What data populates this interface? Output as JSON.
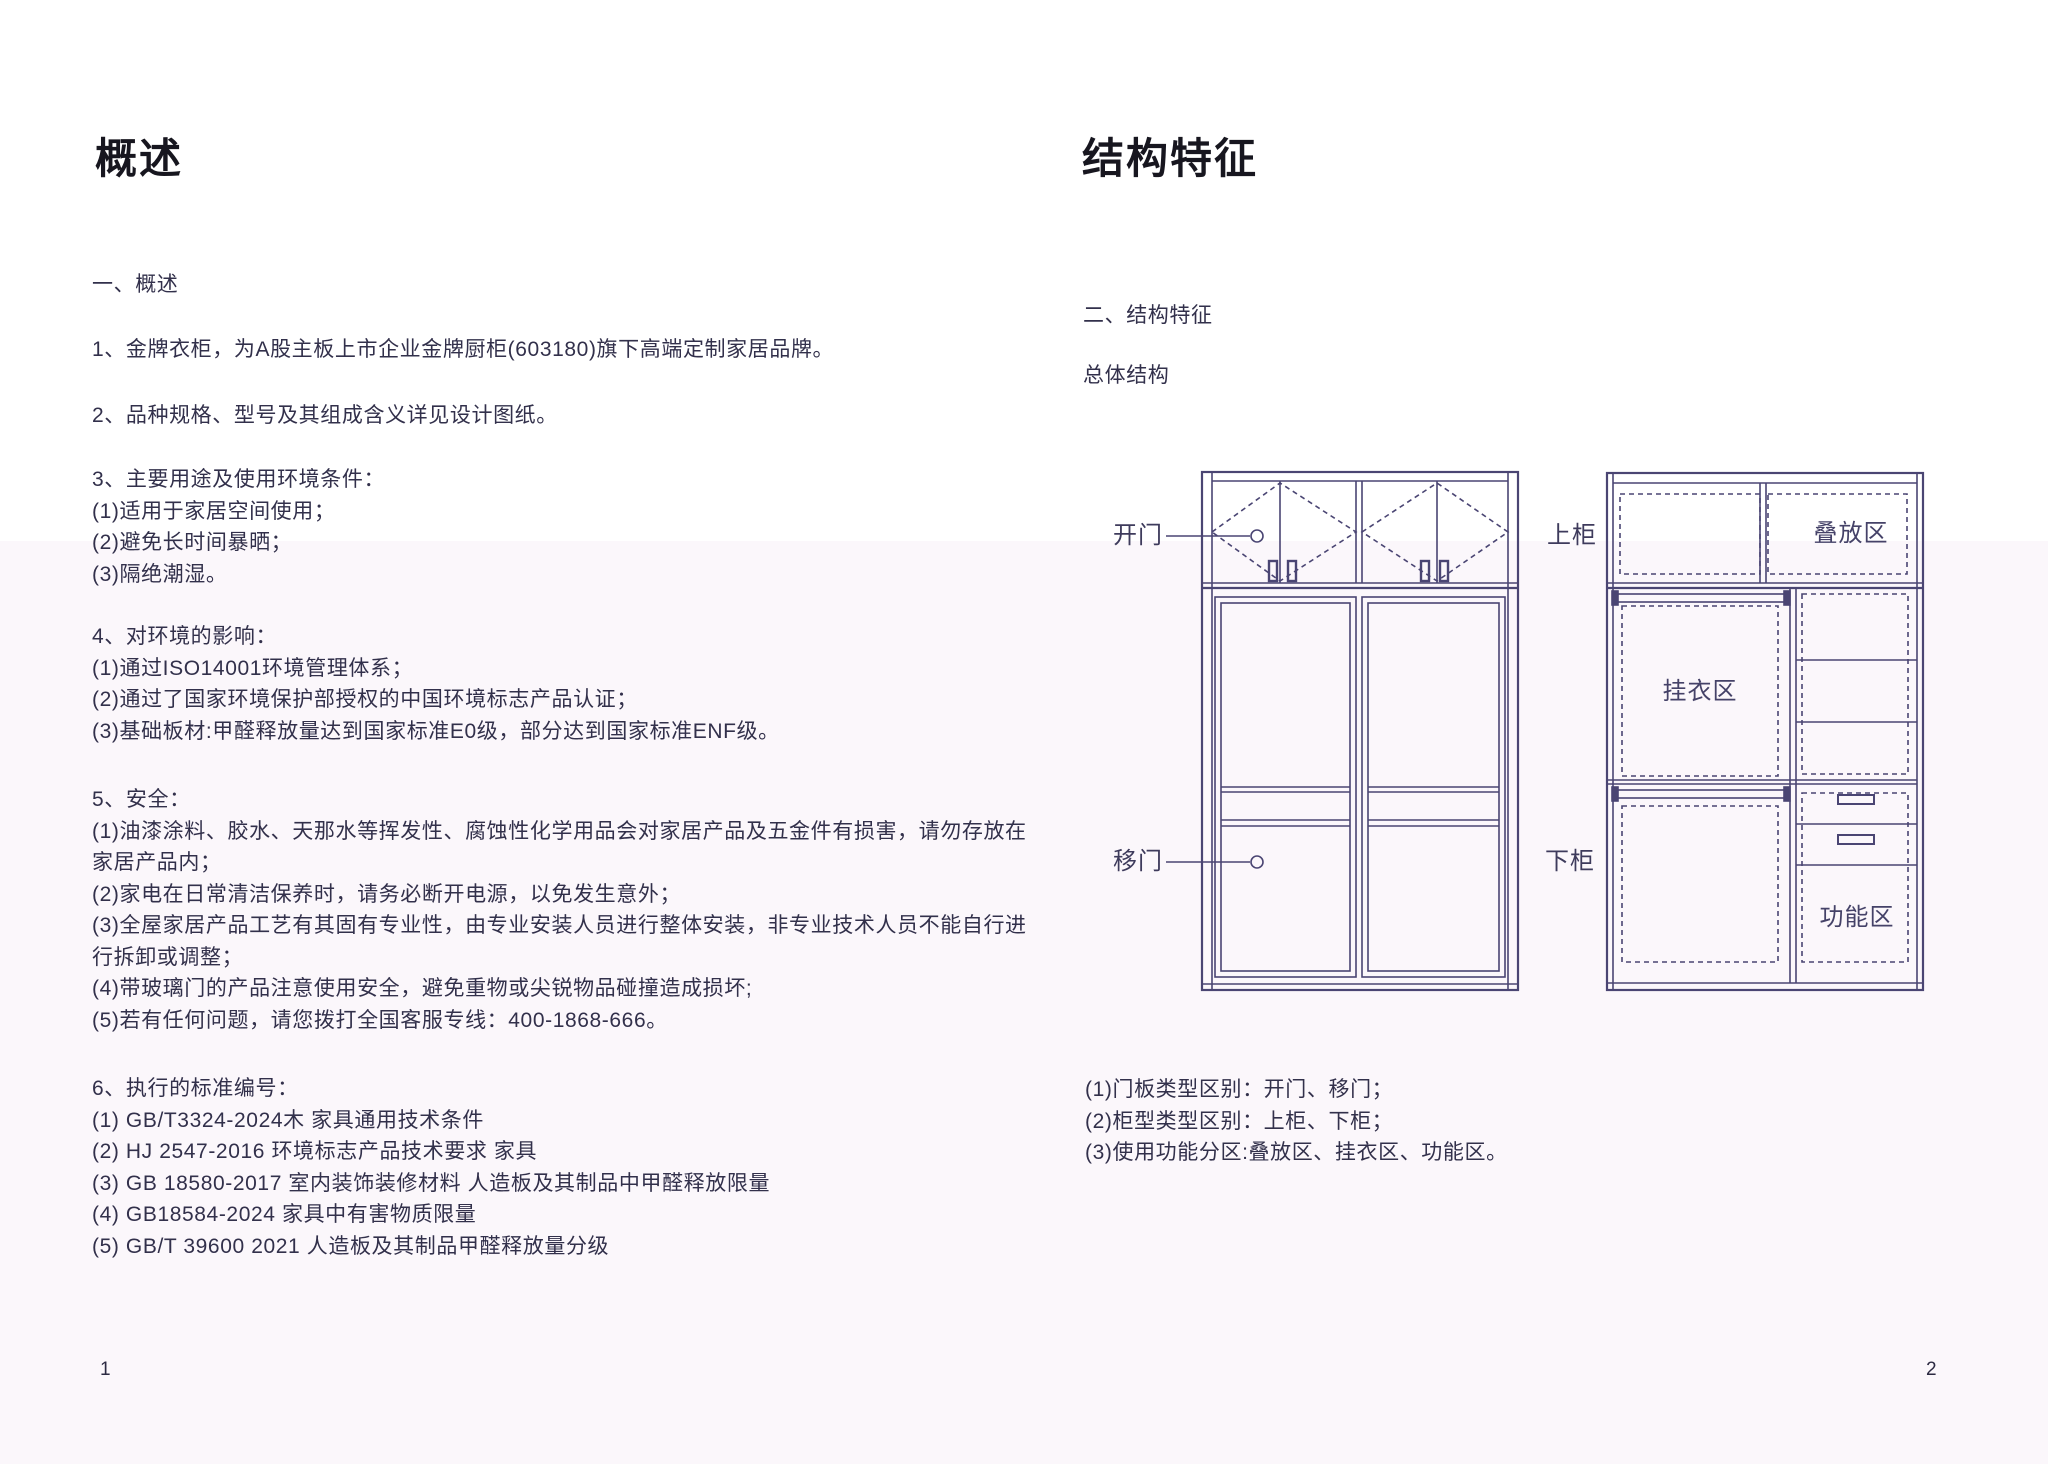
{
  "left_page": {
    "title": "概述",
    "section_heading": "一、概述",
    "intro_items": [
      "1、金牌衣柜，为A股主板上市企业金牌厨柜(603180)旗下高端定制家居品牌。",
      "2、品种规格、型号及其组成含义详见设计图纸。"
    ],
    "usage": {
      "heading": "3、主要用途及使用环境条件：",
      "lines": [
        "(1)适用于家居空间使用；",
        "(2)避免长时间暴晒；",
        "(3)隔绝潮湿。"
      ]
    },
    "environment": {
      "heading": "4、对环境的影响：",
      "lines": [
        "(1)通过ISO14001环境管理体系；",
        "(2)通过了国家环境保护部授权的中国环境标志产品认证；",
        "(3)基础板材:甲醛释放量达到国家标准E0级，部分达到国家标准ENF级。"
      ]
    },
    "safety": {
      "heading": "5、安全：",
      "lines": [
        "(1)油漆涂料、胶水、天那水等挥发性、腐蚀性化学用品会对家居产品及五金件有损害，请勿存放在",
        "家居产品内；",
        "(2)家电在日常清洁保养时，请务必断开电源，以免发生意外；",
        "(3)全屋家居产品工艺有其固有专业性，由专业安装人员进行整体安装，非专业技术人员不能自行进",
        "行拆卸或调整；",
        "(4)带玻璃门的产品注意使用安全，避免重物或尖锐物品碰撞造成损坏;",
        "(5)若有任何问题，请您拨打全国客服专线：400-1868-666。"
      ]
    },
    "standards": {
      "heading": "6、执行的标准编号：",
      "lines": [
        "(1) GB/T3324-2024木 家具通用技术条件",
        "(2) HJ 2547-2016 环境标志产品技术要求 家具",
        "(3) GB 18580-2017 室内装饰装修材料 人造板及其制品中甲醛释放限量",
        "(4) GB18584-2024 家具中有害物质限量",
        "(5) GB/T 39600 2021 人造板及其制品甲醛释放量分级"
      ]
    },
    "page_number": "1"
  },
  "right_page": {
    "title": "结构特征",
    "section_heading": "二、结构特征",
    "subheading": "总体结构",
    "diagram_labels": {
      "open_door": "开门",
      "sliding_door": "移门",
      "upper_cabinet": "上柜",
      "lower_cabinet": "下柜",
      "stacking_zone": "叠放区",
      "hanging_zone": "挂衣区",
      "function_zone": "功能区"
    },
    "notes": [
      "(1)门板类型区别：开门、移门；",
      "(2)柜型类型区别：上柜、下柜；",
      "(3)使用功能分区:叠放区、挂衣区、功能区。"
    ],
    "page_number": "2"
  },
  "colors": {
    "diagram_line": "#4a4573",
    "body_text": "#32304b",
    "tint_band": "#fbf7fb"
  }
}
